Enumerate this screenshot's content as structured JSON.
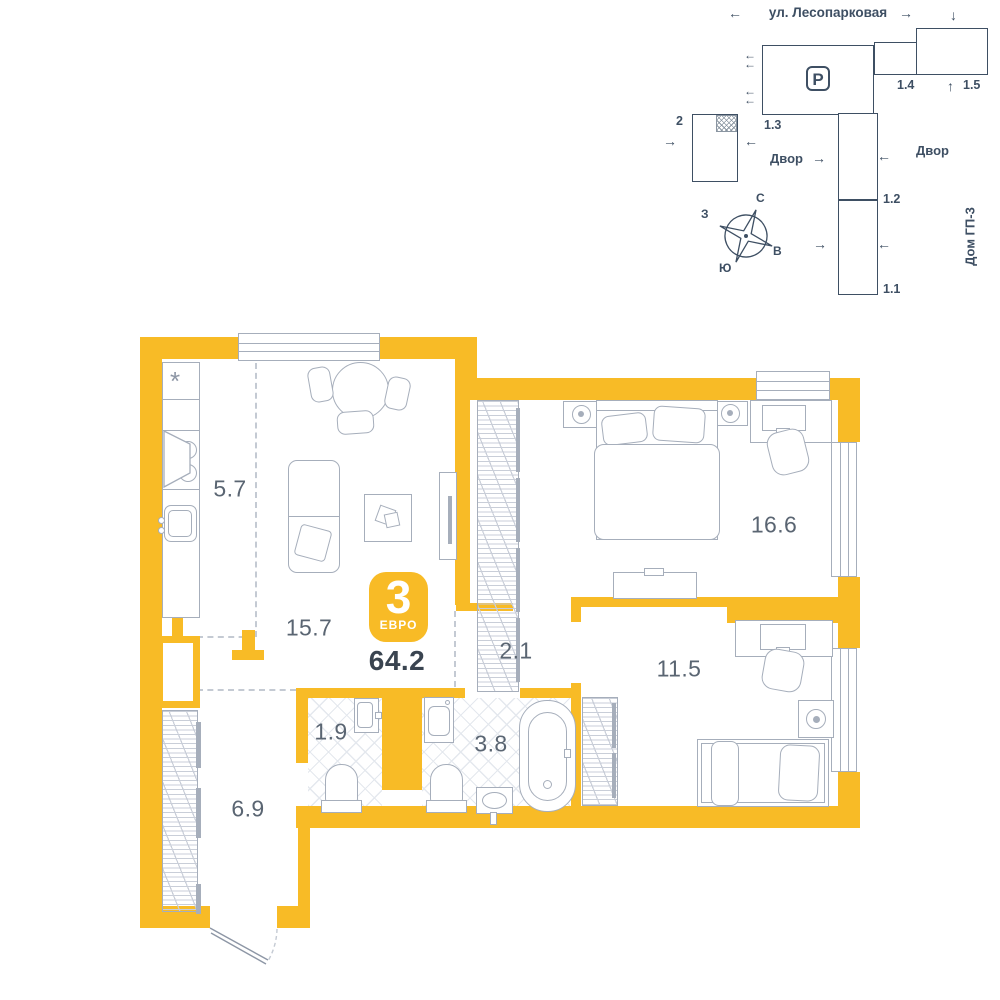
{
  "colors": {
    "wall": "#F8BB26",
    "line": "#A6AEBB",
    "line_dark": "#8D96A5",
    "dash": "#C4CAD3",
    "site": "#3E4F63",
    "room_label": "#5A6572",
    "total": "#3A4450",
    "badge_text": "#FFFFFF",
    "tile_line": "#E4E8EE",
    "hatch_line": "#C9CED8"
  },
  "site_plan": {
    "street_label": "ул. Лесопарковая",
    "parking_icon": "P",
    "yard_label_left": "Двор",
    "yard_label_right": "Двор",
    "neighbor_house_label": "Дом ГП-3",
    "building_labels": {
      "b2": "2",
      "b1_1": "1.1",
      "b1_2": "1.2",
      "b1_3": "1.3",
      "b1_4": "1.4",
      "b1_5": "1.5"
    },
    "compass": {
      "north": "С",
      "south": "Ю",
      "west": "З",
      "east": "В"
    },
    "icons": {
      "arrow_left": "←",
      "arrow_right": "→",
      "arrow_up": "↑",
      "arrow_down": "↓"
    }
  },
  "plan": {
    "badge": {
      "rooms_count": "3",
      "layout_type": "ЕВРО"
    },
    "total_area": "64.2",
    "rooms": [
      {
        "id": "kitchen",
        "area": "5.7"
      },
      {
        "id": "living-room",
        "area": "15.7"
      },
      {
        "id": "bedroom-1",
        "area": "16.6"
      },
      {
        "id": "corridor",
        "area": "2.1"
      },
      {
        "id": "bedroom-2",
        "area": "11.5"
      },
      {
        "id": "wc",
        "area": "1.9"
      },
      {
        "id": "bathroom",
        "area": "3.8"
      },
      {
        "id": "hallway",
        "area": "6.9"
      }
    ],
    "icons": {
      "fridge_snowflake": "*"
    }
  }
}
